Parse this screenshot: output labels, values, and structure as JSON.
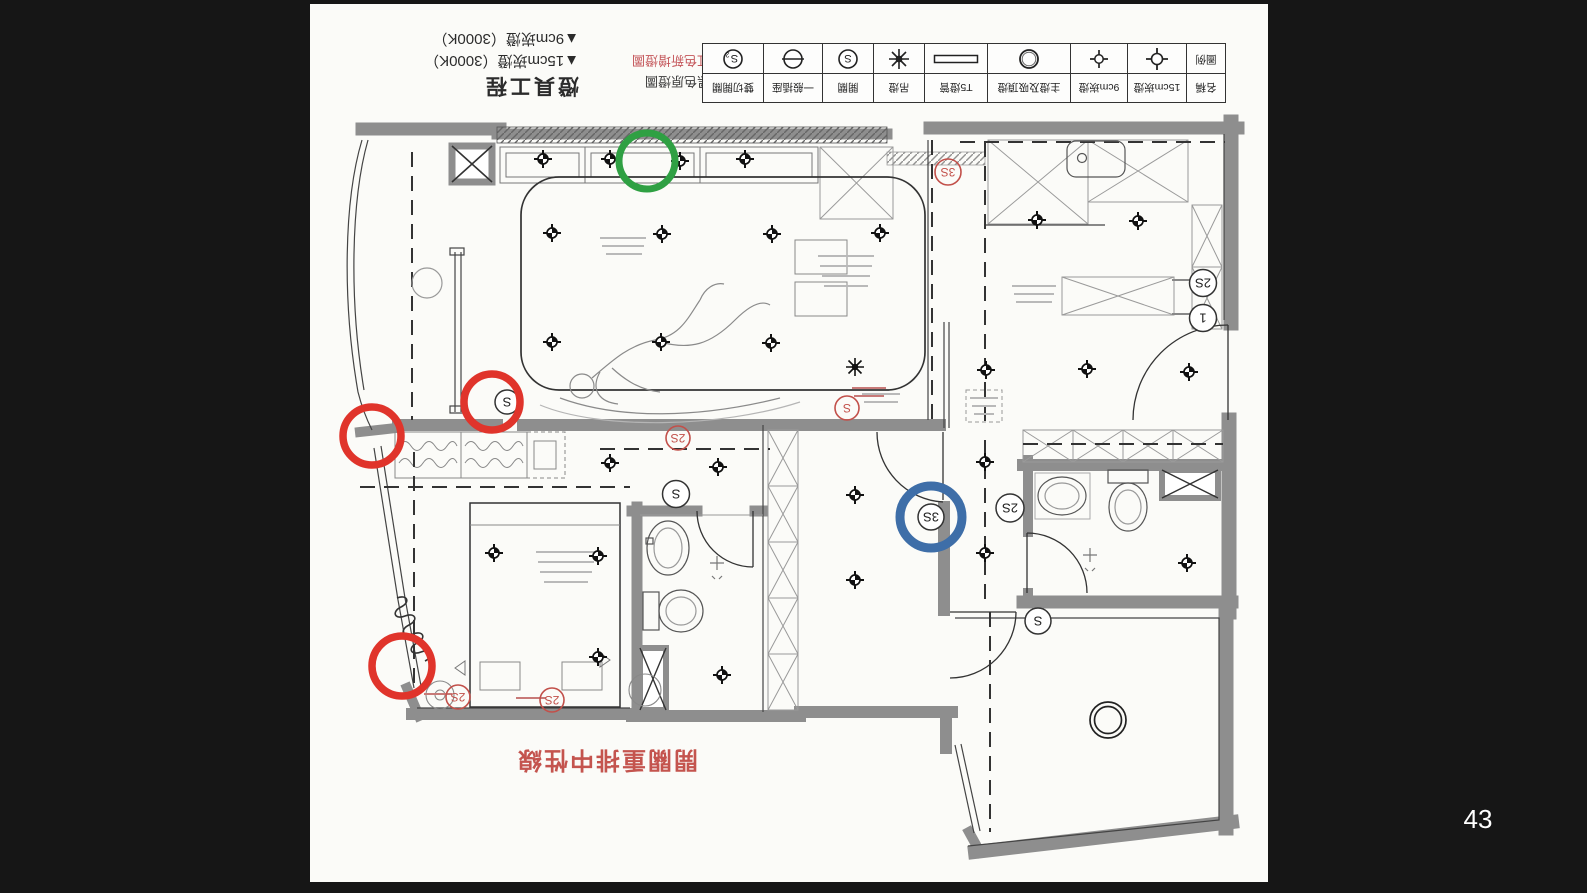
{
  "page_number": "43",
  "titleblock": {
    "title": "燈具工程",
    "line1": "▲15cm崁燈（3000K）",
    "line2": "▲9cm崁燈（3000K）"
  },
  "notes": {
    "line1": "黑色原燈圖",
    "line2": "紅色新增燈圖"
  },
  "legend": {
    "header": {
      "name": "名稱",
      "symbol": "圖例"
    },
    "items": [
      {
        "label": "15cm崁燈",
        "icon": "downlight-15cm-icon"
      },
      {
        "label": "9cm崁燈",
        "icon": "downlight-9cm-icon"
      },
      {
        "label": "主燈及吸頂燈",
        "icon": "ceiling-light-icon"
      },
      {
        "label": "T5燈管",
        "icon": "t5-tube-icon"
      },
      {
        "label": "吊燈",
        "icon": "pendant-light-icon"
      },
      {
        "label": "開關",
        "icon": "switch-icon"
      },
      {
        "label": "一般插座",
        "icon": "outlet-icon"
      },
      {
        "label": "雙切開關",
        "icon": "two-way-switch-icon"
      }
    ]
  },
  "plan_note": "開關重排中性線",
  "plan_labels": {
    "s": "S",
    "s2": "2S",
    "s3": "3S",
    "one": "1",
    "sub2": "2"
  },
  "colors": {
    "annotation_red": "#e0342b",
    "annotation_green": "#2fa043",
    "annotation_blue": "#3e6ea8",
    "plan_red": "#c2504a",
    "wall_gray": "#8e8e8e"
  }
}
